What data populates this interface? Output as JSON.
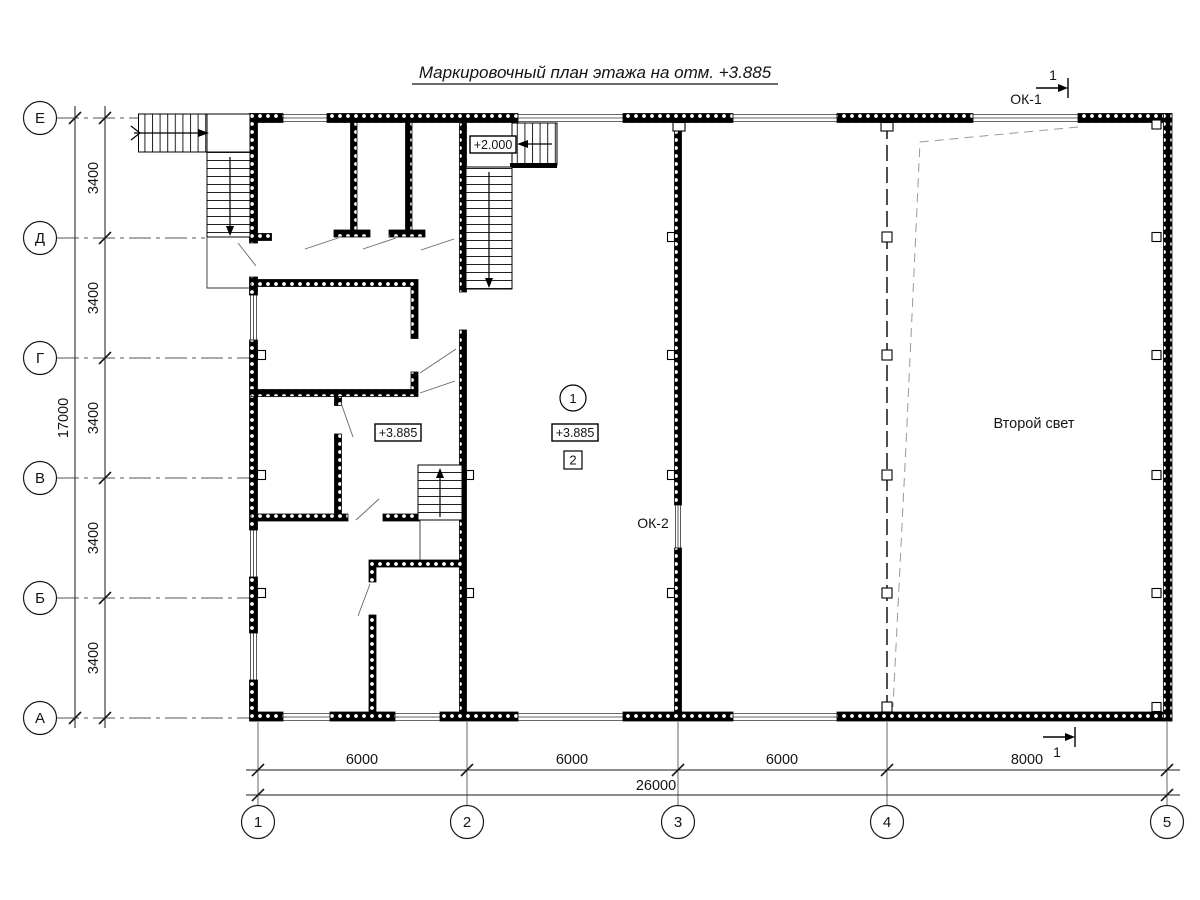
{
  "title": "Маркировочный план этажа на отм. +3.885",
  "axes": {
    "rows": [
      "Е",
      "Д",
      "Г",
      "В",
      "Б",
      "А"
    ],
    "cols": [
      "1",
      "2",
      "3",
      "4",
      "5"
    ]
  },
  "dims": {
    "row_segments": [
      "3400",
      "3400",
      "3400",
      "3400",
      "3400"
    ],
    "row_total": "17000",
    "col_segments": [
      "6000",
      "6000",
      "6000",
      "8000"
    ],
    "col_total": "26000"
  },
  "marks": {
    "section_top": {
      "number": "1",
      "window": "ОК-1"
    },
    "section_bottom": {
      "number": "1"
    }
  },
  "plan": {
    "elev_stair_landing": "+2.000",
    "elev_left_room": "+3.885",
    "elev_hall": "+3.885",
    "hall_axis_node": "1",
    "hall_node": "2",
    "window_mark_2": "ОК-2",
    "second_light": "Второй свет"
  },
  "colors": {
    "line": "#1a1a1a",
    "background": "#ffffff"
  }
}
